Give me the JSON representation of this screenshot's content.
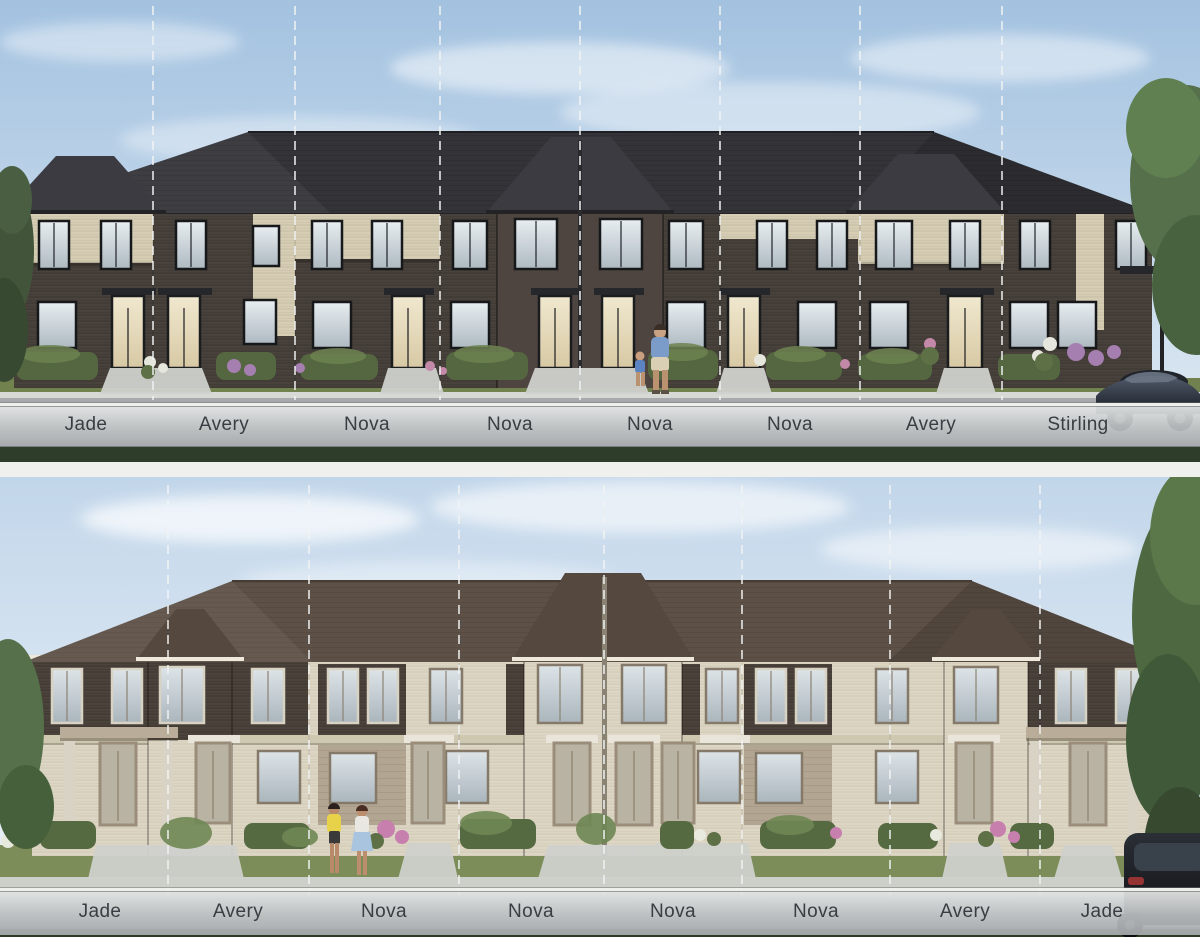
{
  "document": {
    "kind": "streetscape-elevation-sheet",
    "description": "Two townhome streetscape renderings stacked vertically, each with a translucent bar listing the unit model names and dashed white lines marking unit divisions."
  },
  "elevations": [
    {
      "id": "upper-streetscape",
      "scheme": "dark brick with cream accents, charcoal roof",
      "units": [
        {
          "label": "Jade"
        },
        {
          "label": "Avery"
        },
        {
          "label": "Nova"
        },
        {
          "label": "Nova"
        },
        {
          "label": "Nova"
        },
        {
          "label": "Nova"
        },
        {
          "label": "Avery"
        },
        {
          "label": "Stirling"
        }
      ]
    },
    {
      "id": "lower-streetscape",
      "scheme": "cream brick with dark brown accents, brown roof",
      "units": [
        {
          "label": "Jade"
        },
        {
          "label": "Avery"
        },
        {
          "label": "Nova"
        },
        {
          "label": "Nova"
        },
        {
          "label": "Nova"
        },
        {
          "label": "Nova"
        },
        {
          "label": "Avery"
        },
        {
          "label": "Jade"
        }
      ]
    }
  ],
  "palette": {
    "sky_top": "#a3c2e0",
    "sky_bottom": "#e8f0f7",
    "dark_brick": "#48413c",
    "cream_brick": "#d6cdb4",
    "lower_cream_brick": "#ddd6c4",
    "lower_dark_brick": "#4b433c",
    "roof_charcoal": "#333338",
    "roof_brown": "#5d5046",
    "label_bar": "#c4c8c9",
    "label_text": "#3a3d41",
    "lawn": "#7a8a58",
    "road": "#8f9395"
  }
}
